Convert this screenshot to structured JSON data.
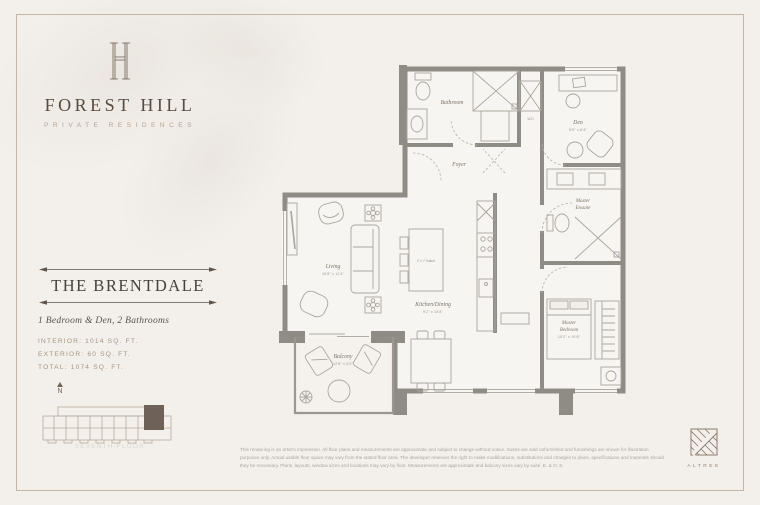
{
  "brand": {
    "monogram": "FH",
    "name": "FOREST HILL",
    "tagline": "PRIVATE RESIDENCES"
  },
  "unit": {
    "name": "THE BRENTDALE",
    "type": "1 Bedroom & Den, 2 Bathrooms",
    "interior": "INTERIOR: 1014 SQ. FT.",
    "exterior": "EXTERIOR: 60 SQ. FT.",
    "total": "TOTAL: 1074 SQ. FT."
  },
  "keyplan": {
    "north_label": "N",
    "caption": "SEVENTH FLOOR"
  },
  "plan": {
    "rooms": {
      "bathroom": {
        "label": "Bathroom"
      },
      "wd": {
        "label": "W.D."
      },
      "den": {
        "label": "Den",
        "dims": "8'6\" x 8'4\""
      },
      "foyer": {
        "label": "Foyer"
      },
      "ensuite": {
        "line1": "Master",
        "line2": "Ensuite"
      },
      "living": {
        "label": "Living",
        "dims": "10'6\" x 11'4\""
      },
      "kitchen": {
        "label": "Kitchen/Dining",
        "dims": "9'2\" x 14'8\""
      },
      "island": {
        "label": "2' x 7' Island"
      },
      "bedroom": {
        "line1": "Master",
        "line2": "Bedroom",
        "dims": "10'2\" x 10'8\""
      },
      "balcony": {
        "label": "Balcony",
        "dims": "12'8\" x 5'0\""
      }
    }
  },
  "footer": {
    "disclaimer": "This rendering is an artist's impression. All floor plans and measurements are approximate and subject to change without notice. Suites are sold unfurnished and furnishings are shown for illustration purposes only. Actual usable floor space may vary from the stated floor area. The developer reserves the right to make modifications, substitutions and changes to plans, specifications and materials should they be necessary. Plans, layouts, window sizes and locations may vary by floor. Measurements are approximate and balcony sizes vary by suite. E. & O. E.",
    "logo_name": "ALTREE"
  }
}
